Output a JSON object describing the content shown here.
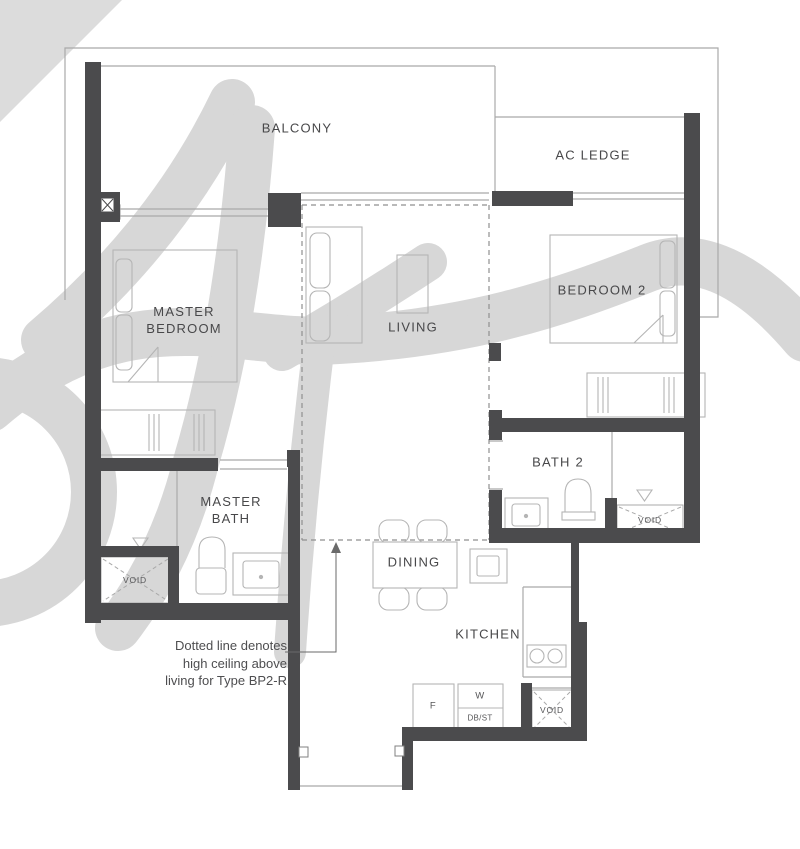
{
  "plan": {
    "title": "Floor plan Type BP2-R (2-bedroom unit)",
    "rooms": [
      {
        "id": "balcony",
        "label": "BALCONY"
      },
      {
        "id": "ac-ledge",
        "label": "AC LEDGE"
      },
      {
        "id": "master-bedroom",
        "label": "MASTER\nBEDROOM"
      },
      {
        "id": "living",
        "label": "LIVING"
      },
      {
        "id": "bedroom-2",
        "label": "BEDROOM 2"
      },
      {
        "id": "master-bath",
        "label": "MASTER\nBATH"
      },
      {
        "id": "bath-2",
        "label": "BATH 2"
      },
      {
        "id": "dining",
        "label": "DINING"
      },
      {
        "id": "kitchen",
        "label": "KITCHEN"
      }
    ],
    "voids": [
      {
        "id": "void-master-bath",
        "label": "VOID"
      },
      {
        "id": "void-bath-2",
        "label": "VOID"
      },
      {
        "id": "void-kitchen",
        "label": "VOID"
      }
    ],
    "appliances": [
      {
        "id": "fridge",
        "label": "F"
      },
      {
        "id": "washer",
        "label": "W"
      },
      {
        "id": "db-store",
        "label": "DB/ST"
      }
    ],
    "note": {
      "text": "Dotted line denotes\nhigh ceiling above\nliving for Type BP2-R"
    },
    "colors": {
      "wall": "#4b4b4d",
      "thin_line": "#a9a9a9",
      "furniture_line": "#b5b5b5",
      "dashed_line": "#8f8f8f",
      "text": "#48484a",
      "watermark": "#d7d7d7",
      "background": "#ffffff"
    }
  }
}
